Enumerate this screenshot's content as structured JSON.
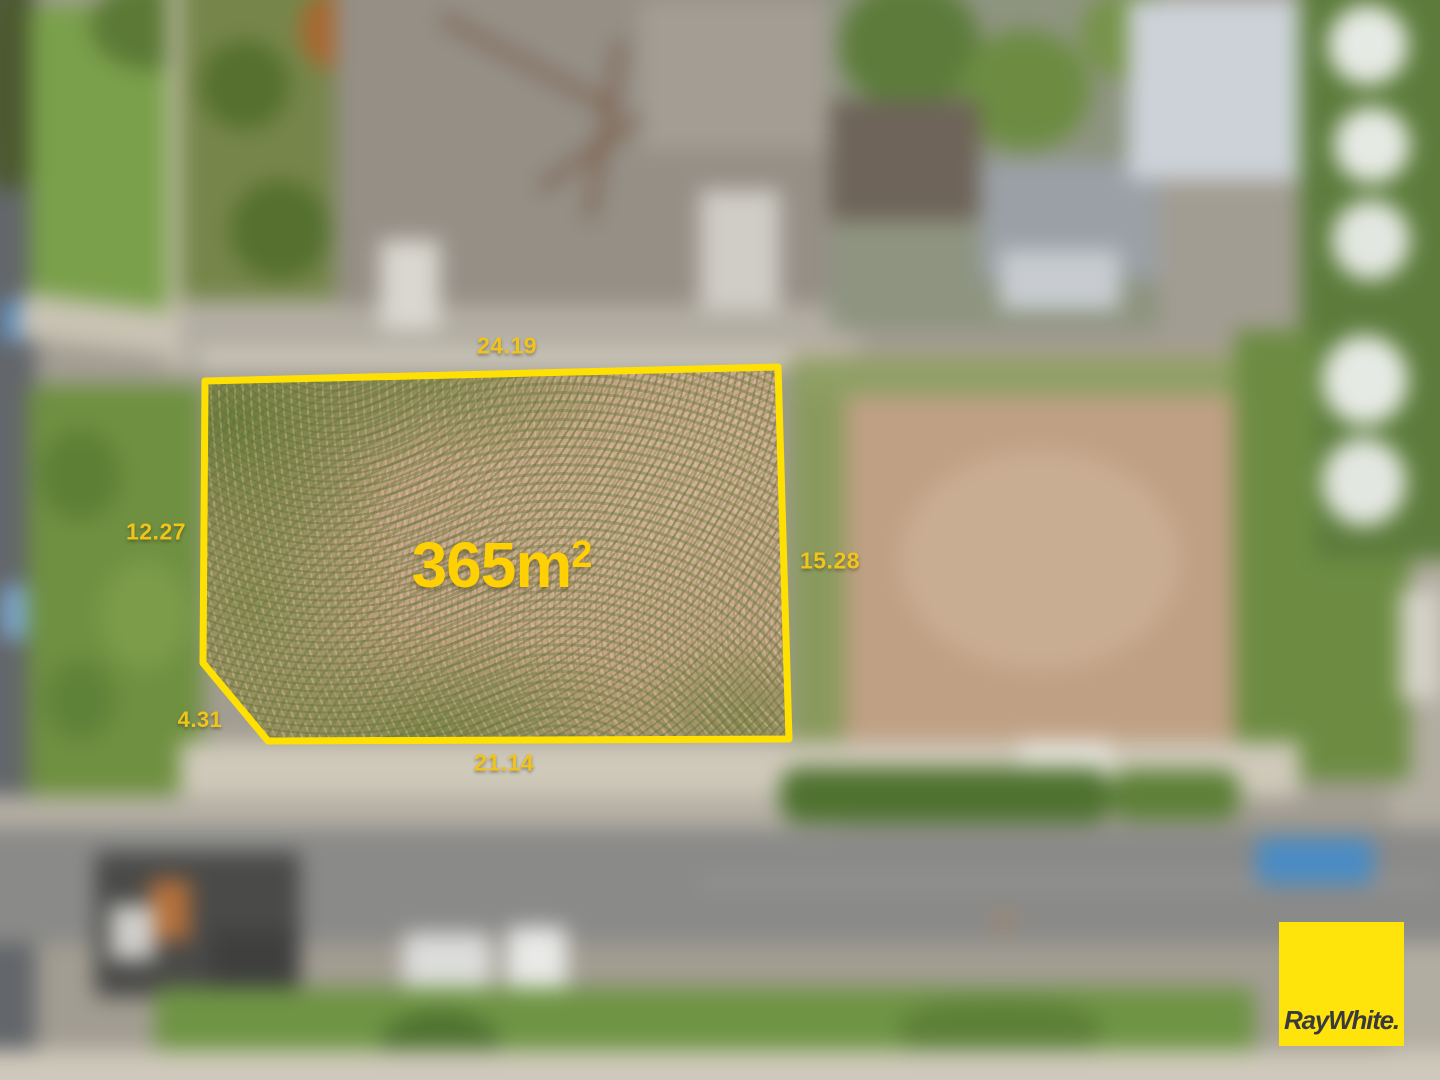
{
  "lot": {
    "area_value": "365m",
    "area_exponent": "2",
    "dimensions": {
      "top": "24.19",
      "left": "12.27",
      "right": "15.28",
      "bottom_left": "4.31",
      "bottom": "21.14"
    },
    "boundary_color": "#FFE003",
    "dimension_label_color": "#F2C31B",
    "area_label_color": "#FFD002"
  },
  "branding": {
    "logo_text": "RayWhite.",
    "logo_background": "#FFE40B",
    "logo_text_color": "#3A3A3C"
  }
}
